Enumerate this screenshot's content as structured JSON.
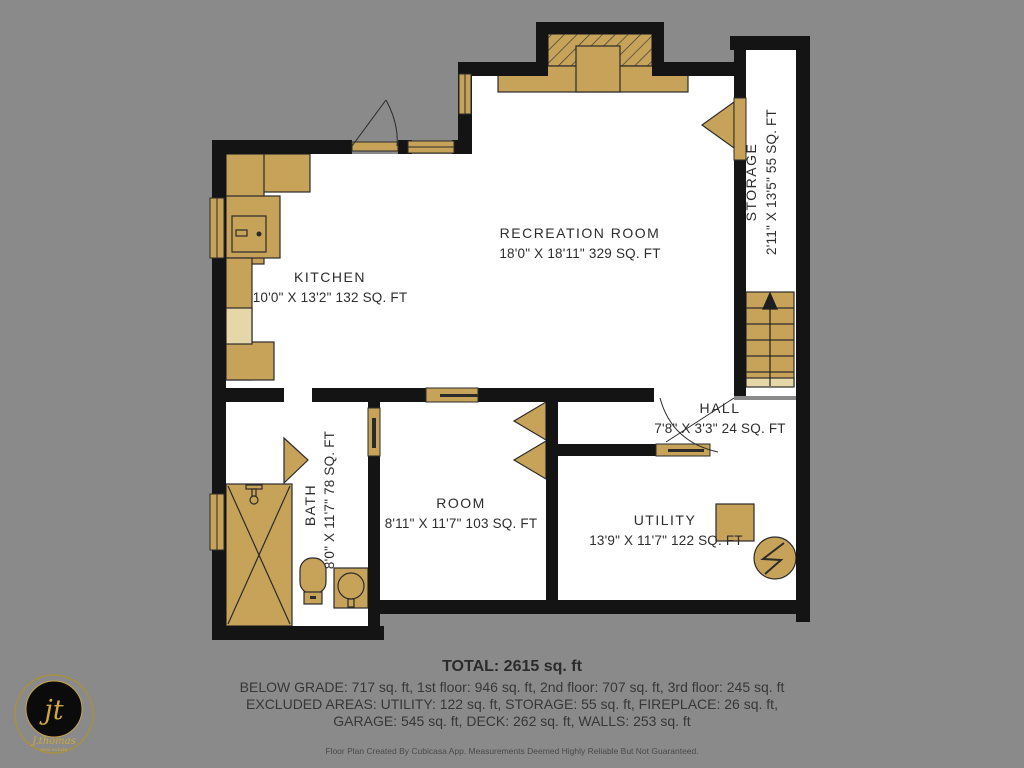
{
  "rooms": {
    "kitchen": {
      "name": "KITCHEN",
      "dims": "10'0\" X 13'2\" 132 SQ. FT"
    },
    "recreation": {
      "name": "RECREATION ROOM",
      "dims": "18'0\" X 18'11\" 329 SQ. FT"
    },
    "storage": {
      "name": "STORAGE",
      "dims": "2'11\" X 13'5\" 55 SQ. FT"
    },
    "hall": {
      "name": "HALL",
      "dims": "7'8\" X 3'3\" 24 SQ. FT"
    },
    "bath": {
      "name": "BATH",
      "dims": "8'0\" X 11'7\" 78 SQ. FT"
    },
    "room": {
      "name": "ROOM",
      "dims": "8'11\" X 11'7\" 103 SQ. FT"
    },
    "utility": {
      "name": "UTILITY",
      "dims": "13'9\" X 11'7\" 122 SQ. FT"
    }
  },
  "summary": {
    "total": "TOTAL: 2615 sq. ft",
    "floors": "BELOW GRADE: 717 sq. ft, 1st floor: 946 sq. ft, 2nd floor: 707 sq. ft, 3rd floor: 245 sq. ft",
    "excluded_a": "EXCLUDED AREAS: UTILITY: 122 sq. ft, STORAGE: 55 sq. ft, FIREPLACE: 26 sq. ft,",
    "excluded_b": "GARAGE: 545 sq. ft, DECK: 262 sq. ft, WALLS: 253 sq. ft",
    "disclaimer": "Floor Plan Created By Cubicasa App. Measurements Deemed Highly Reliable But Not Guaranteed."
  },
  "logo": {
    "monogram": "jt",
    "name": "J.thomas",
    "tagline": "real estate"
  },
  "colors": {
    "background": "#8a8a8a",
    "wall": "#141414",
    "room_fill": "#ffffff",
    "fixture_tan": "#c7a35a",
    "fixture_tan_light": "#e6d7a9",
    "logo_gold": "#cfa83d",
    "label_text": "#2d2d2d"
  }
}
